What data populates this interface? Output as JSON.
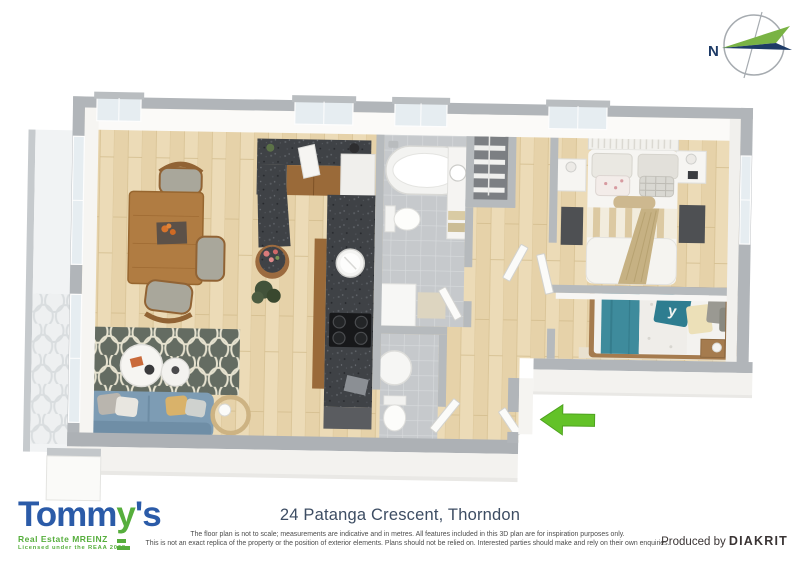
{
  "compass": {
    "label": "N",
    "green": "#79b344",
    "navy": "#1d3a66"
  },
  "floorplan": {
    "entry_arrow_color": "#63c228"
  },
  "footer": {
    "address_title": "24 Patanga Crescent, Thorndon",
    "disclaimer_line1": "The floor plan is not to scale; measurements are indicative and in metres. All features included in this 3D plan are for inspiration purposes only.",
    "disclaimer_line2": "This is not an exact replica of the property or the position of exterior elements. Plans should not be relied on. Interested parties should make and rely on their own enquiries.",
    "credit_prefix": "Produced by ",
    "credit_brand": "DIAKRIT"
  },
  "logo": {
    "word_part1": "Tomm",
    "word_part2": "y",
    "word_part3": "'s",
    "tagline": "Real Estate MREINZ",
    "license": "Licensed under the REAA 2008",
    "blue": "#2b5ba8",
    "green": "#56ae3c"
  },
  "colors": {
    "title_navy": "#3d4d63",
    "disclaimer_gray": "#4c4c4c",
    "credit_dark": "#3a3434"
  }
}
